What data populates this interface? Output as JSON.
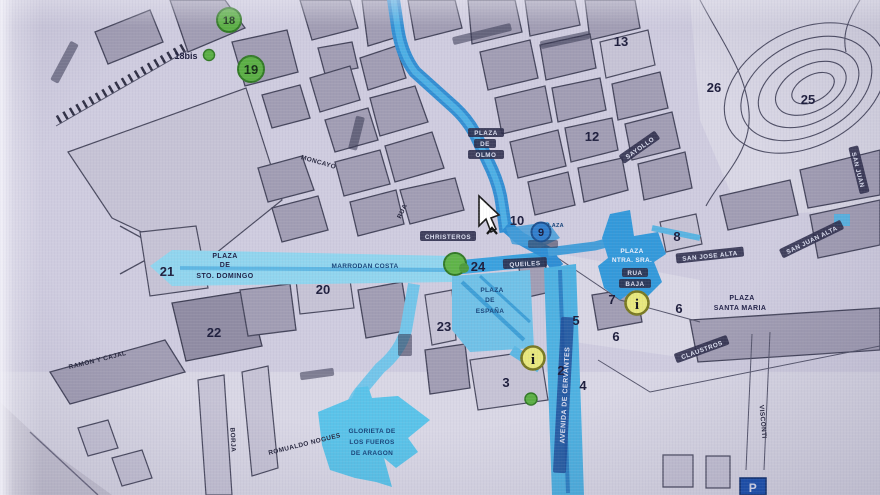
{
  "map": {
    "kind": "street-map photo (screen capture of a tourist town plan with highlighted route)",
    "numbers": {
      "n2": "2",
      "n3": "3",
      "n4": "4",
      "n5": "5",
      "n6a": "6",
      "n6b": "6",
      "n7": "7",
      "n8": "8",
      "n9": "9",
      "n10": "10",
      "n12": "12",
      "n13": "13",
      "n18": "18",
      "n18bis": "18bis",
      "n19": "19",
      "n20": "20",
      "n21": "21",
      "n22": "22",
      "n23": "23",
      "n24": "24",
      "n25": "25",
      "n26": "26"
    },
    "plazas": {
      "sto_domingo": [
        "PLAZA",
        "DE",
        "STO. DOMINGO"
      ],
      "espana": [
        "PLAZA",
        "DE",
        "ESPAÑA"
      ],
      "santa_maria": [
        "PLAZA",
        "SANTA MARIA"
      ],
      "ntra_sra": [
        "PLAZA",
        "NTRA. SRA."
      ],
      "rua_baja": [
        "RUA",
        "BAJA"
      ],
      "del_olmo": [
        "PLAZA",
        "DE",
        "OLMO"
      ],
      "glorieta": [
        "GLORIETA DE",
        "LOS FUEROS",
        "DE ARAGON"
      ],
      "center_small": "PLAZA"
    },
    "streets": {
      "moncayo": "MONCAYO",
      "marrodan_costa": "MARRODAN COSTA",
      "christeros": "CHRISTEROS",
      "rua": "RUA",
      "queiles": "QUEILES",
      "san_jose_alta": "SAN JOSE ALTA",
      "san_juan_alta": "SAN JUAN ALTA",
      "san_juan": "SAN JUAN",
      "sayollo": "SAYOLLO",
      "claustros": "CLAUSTROS",
      "visconti": "VISCONTI",
      "avenida_cervantes": "AVENIDA DE CERVANTES",
      "ramon_y_cajal": "RAMON Y CAJAL",
      "romualdo_nogues": "ROMUALDO NOGUES",
      "borja": "BORJA"
    },
    "icons": {
      "info": "i",
      "parking": "P"
    },
    "colors": {
      "background": "#cfcce0",
      "building_grey": "#a19db4",
      "route_blue": "#2f8fd6",
      "band_cyan": "#8ed6f0",
      "plaza_blue": "#6cc2ea",
      "marker_green": "#58b040",
      "info_yellow": "#e8e878",
      "number_ink": "#1c1c3c",
      "parking_blue": "#1650b4"
    }
  }
}
